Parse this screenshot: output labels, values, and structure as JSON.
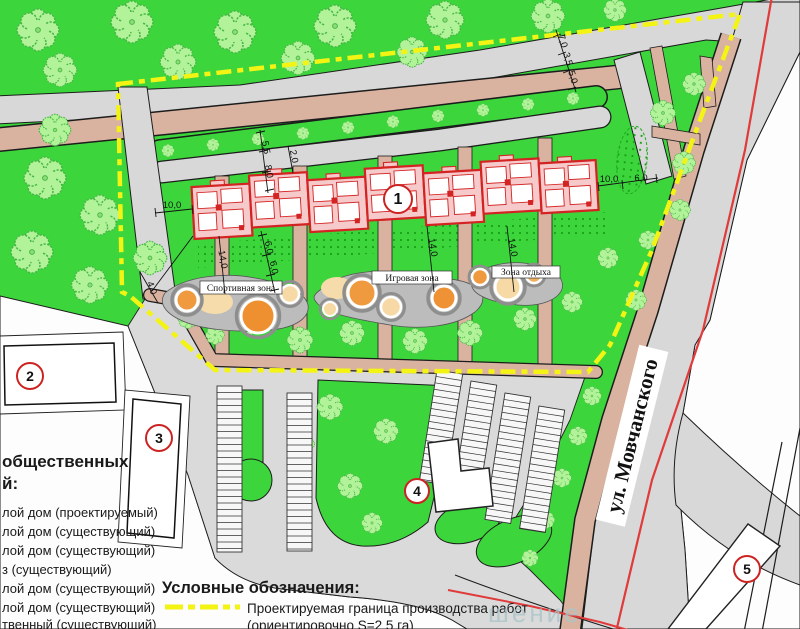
{
  "street_label": "ул. Мовчанского",
  "zones": {
    "sport": "Спортивная зона",
    "play": "Игровая зона",
    "rest": "Зона отдыха"
  },
  "buildings": {
    "b1": "1",
    "b2": "2",
    "b3": "3",
    "b4": "4",
    "b5": "5"
  },
  "dimensions": [
    {
      "text": "7,0",
      "x": 560,
      "y": 42,
      "rot": 73
    },
    {
      "text": "3,5",
      "x": 565,
      "y": 60,
      "rot": 73
    },
    {
      "text": "5,0",
      "x": 570,
      "y": 78,
      "rot": 73
    },
    {
      "text": "5,5",
      "x": 263,
      "y": 148,
      "rot": 80
    },
    {
      "text": "8,0",
      "x": 266,
      "y": 172,
      "rot": 80
    },
    {
      "text": "2,0",
      "x": 291,
      "y": 157,
      "rot": 80
    },
    {
      "text": "10,0",
      "x": 172,
      "y": 208,
      "rot": 0
    },
    {
      "text": "6,0",
      "x": 266,
      "y": 248,
      "rot": 80
    },
    {
      "text": "6,0",
      "x": 271,
      "y": 268,
      "rot": 80
    },
    {
      "text": "14,0",
      "x": 220,
      "y": 260,
      "rot": 80
    },
    {
      "text": "14,0",
      "x": 430,
      "y": 248,
      "rot": 80
    },
    {
      "text": "14,0",
      "x": 510,
      "y": 248,
      "rot": 80
    },
    {
      "text": "10,0",
      "x": 609,
      "y": 182,
      "rot": 0
    },
    {
      "text": "6,0",
      "x": 641,
      "y": 181,
      "rot": 0
    },
    {
      "text": "4,0",
      "x": 149,
      "y": 289,
      "rot": 70
    }
  ],
  "explication": {
    "title_line1": "общественных",
    "title_line2": "й:",
    "items": [
      "лой дом (проектируемый)",
      "лой дом (существующий)",
      "лой дом (существующий)",
      "з (существующий)",
      "лой дом (существующий)",
      "лой дом (существующий)",
      "твенный (существующий)",
      "лой дом (существующий)"
    ]
  },
  "legend": {
    "title": "Условные обозначения:",
    "item1_line1": "Проектируемая граница производства работ",
    "item1_line2": "(ориентировочно S=2,5 га)"
  },
  "watermark": "шение",
  "colors": {
    "lawn": "#3cd63c",
    "road_gray": "#d8d8d8",
    "path_tan": "#d9b3a0",
    "boundary_yellow": "#f4f414",
    "red_line": "#e03a3a",
    "building_outline": "#d42323",
    "building_fill": "#f6caca",
    "playground_gray": "#bcbcbc",
    "sand": "#f6dcab",
    "orange_circle": "#f09a40"
  }
}
